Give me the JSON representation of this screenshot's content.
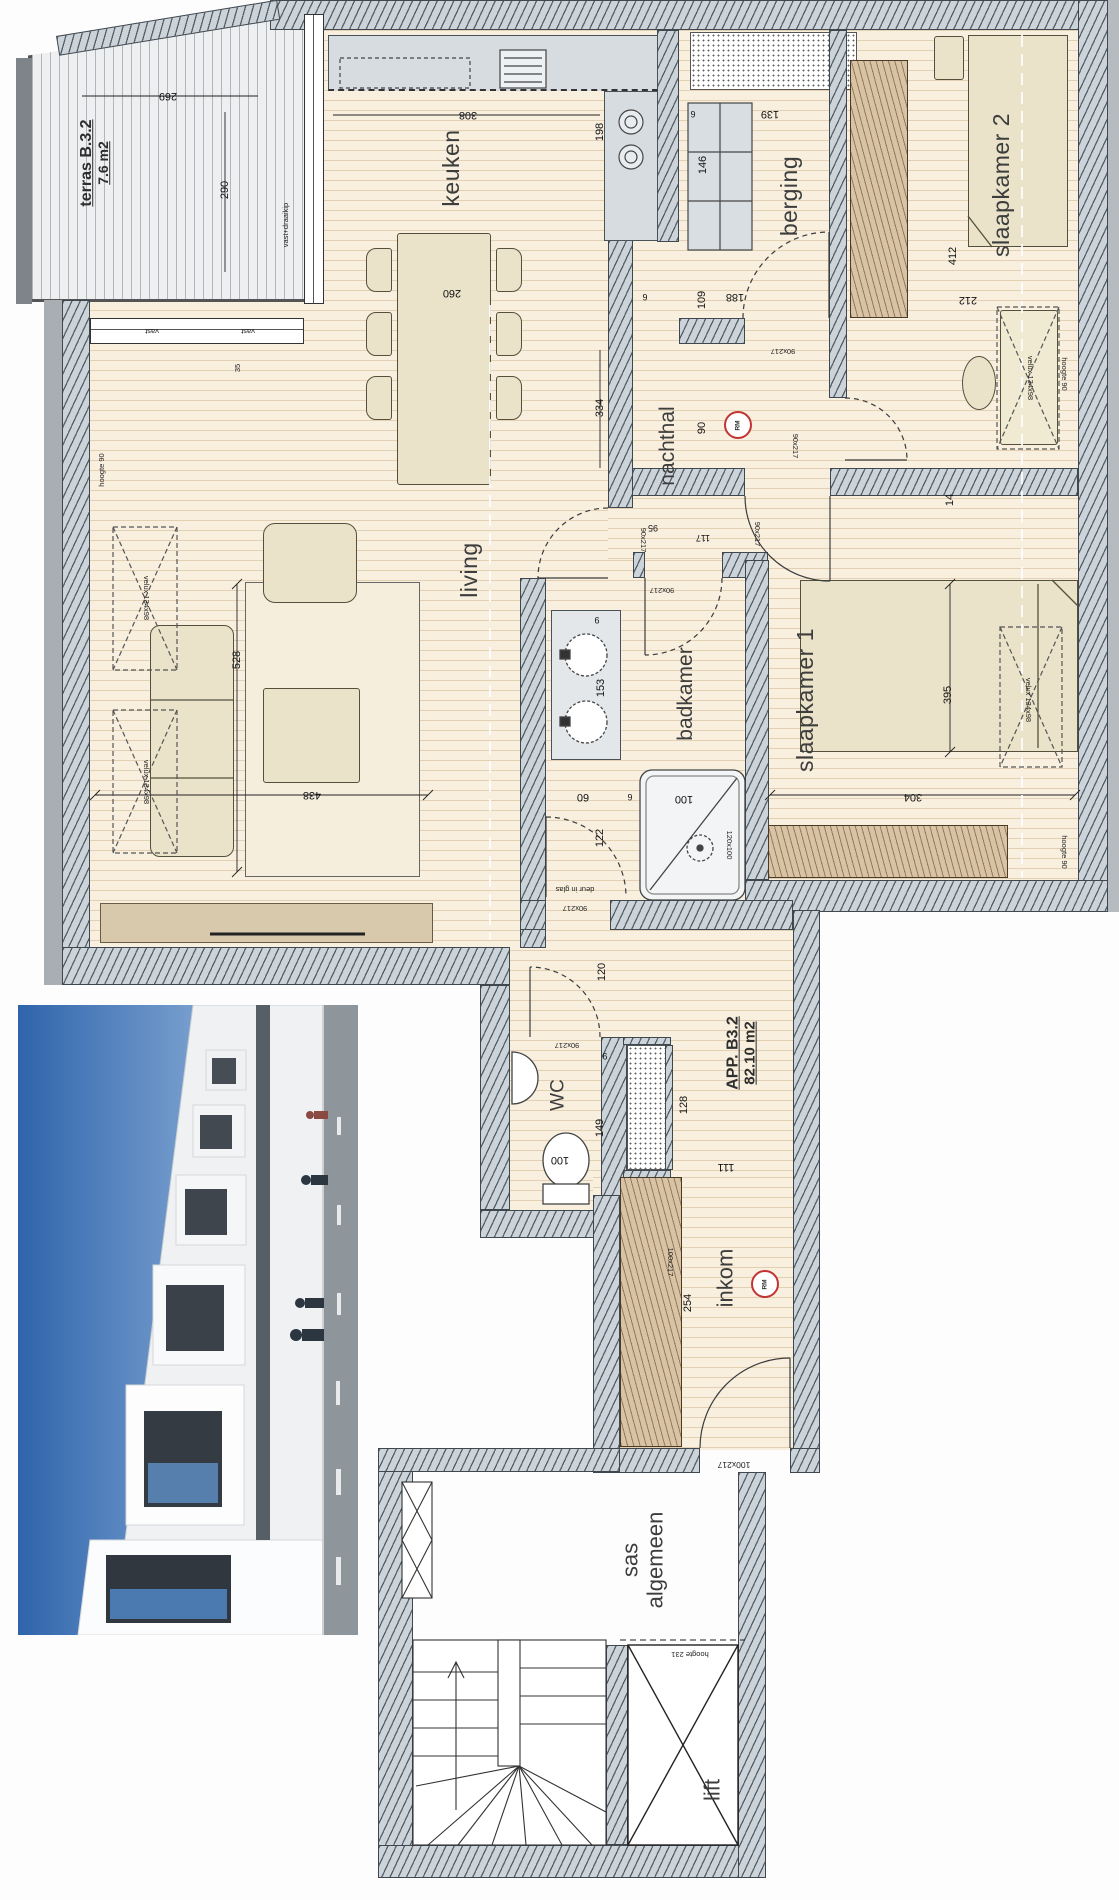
{
  "plan": {
    "app": {
      "name": "APP. B3.2",
      "area": "82.10 m2"
    },
    "terras": {
      "name": "terras B.3.2",
      "area": "7.6 m2"
    },
    "rooms": {
      "keuken": "keuken",
      "berging": "berging",
      "slaapkamer2": "slaapkamer 2",
      "slaapkamer1": "slaapkamer 1",
      "nachthal": "nachthal",
      "living": "living",
      "badkamer": "badkamer",
      "wc": "WC",
      "inkom": "inkom",
      "sas_line1": "sas",
      "sas_line2": "algemeen",
      "lift": "lift"
    },
    "dimensions": {
      "t269": "269",
      "t290": "290",
      "k308": "308",
      "k198": "198",
      "k260": "260",
      "b146": "146",
      "b139": "139",
      "b188": "188",
      "b109": "109",
      "s2a": "412",
      "s2b": "212",
      "w14": "14",
      "n334": "334",
      "n90": "90",
      "d95": "95",
      "d117": "117",
      "l528": "528",
      "l438": "438",
      "bk153": "153",
      "s60": "60",
      "bk122": "122",
      "h120": "120",
      "wc149": "149",
      "i128": "128",
      "i111": "111",
      "i254": "254",
      "s395": "395",
      "s304": "304",
      "w35": "35",
      "six": "6",
      "nine": "9",
      "hundred": "100"
    },
    "tags": {
      "door90": "90x217",
      "door100": "100x217",
      "velux": "velux 134x98",
      "hoogte90": "hoogte 90",
      "hoogte231": "hoogte 231",
      "vast": "vast",
      "vast_draaikip": "vast+draaikip",
      "deur_glas": "deur in glas",
      "shower": "120x100",
      "rm": "RM"
    },
    "colors": {
      "floor": "#f8efdf",
      "floor_line": "#c19c69",
      "wall": "#ccd4da",
      "wall_line": "#3f474f",
      "wood": "#d9c3a5",
      "furniture": "#eae3c9",
      "terras": "#edeff1",
      "accent_red": "#c23434"
    }
  }
}
